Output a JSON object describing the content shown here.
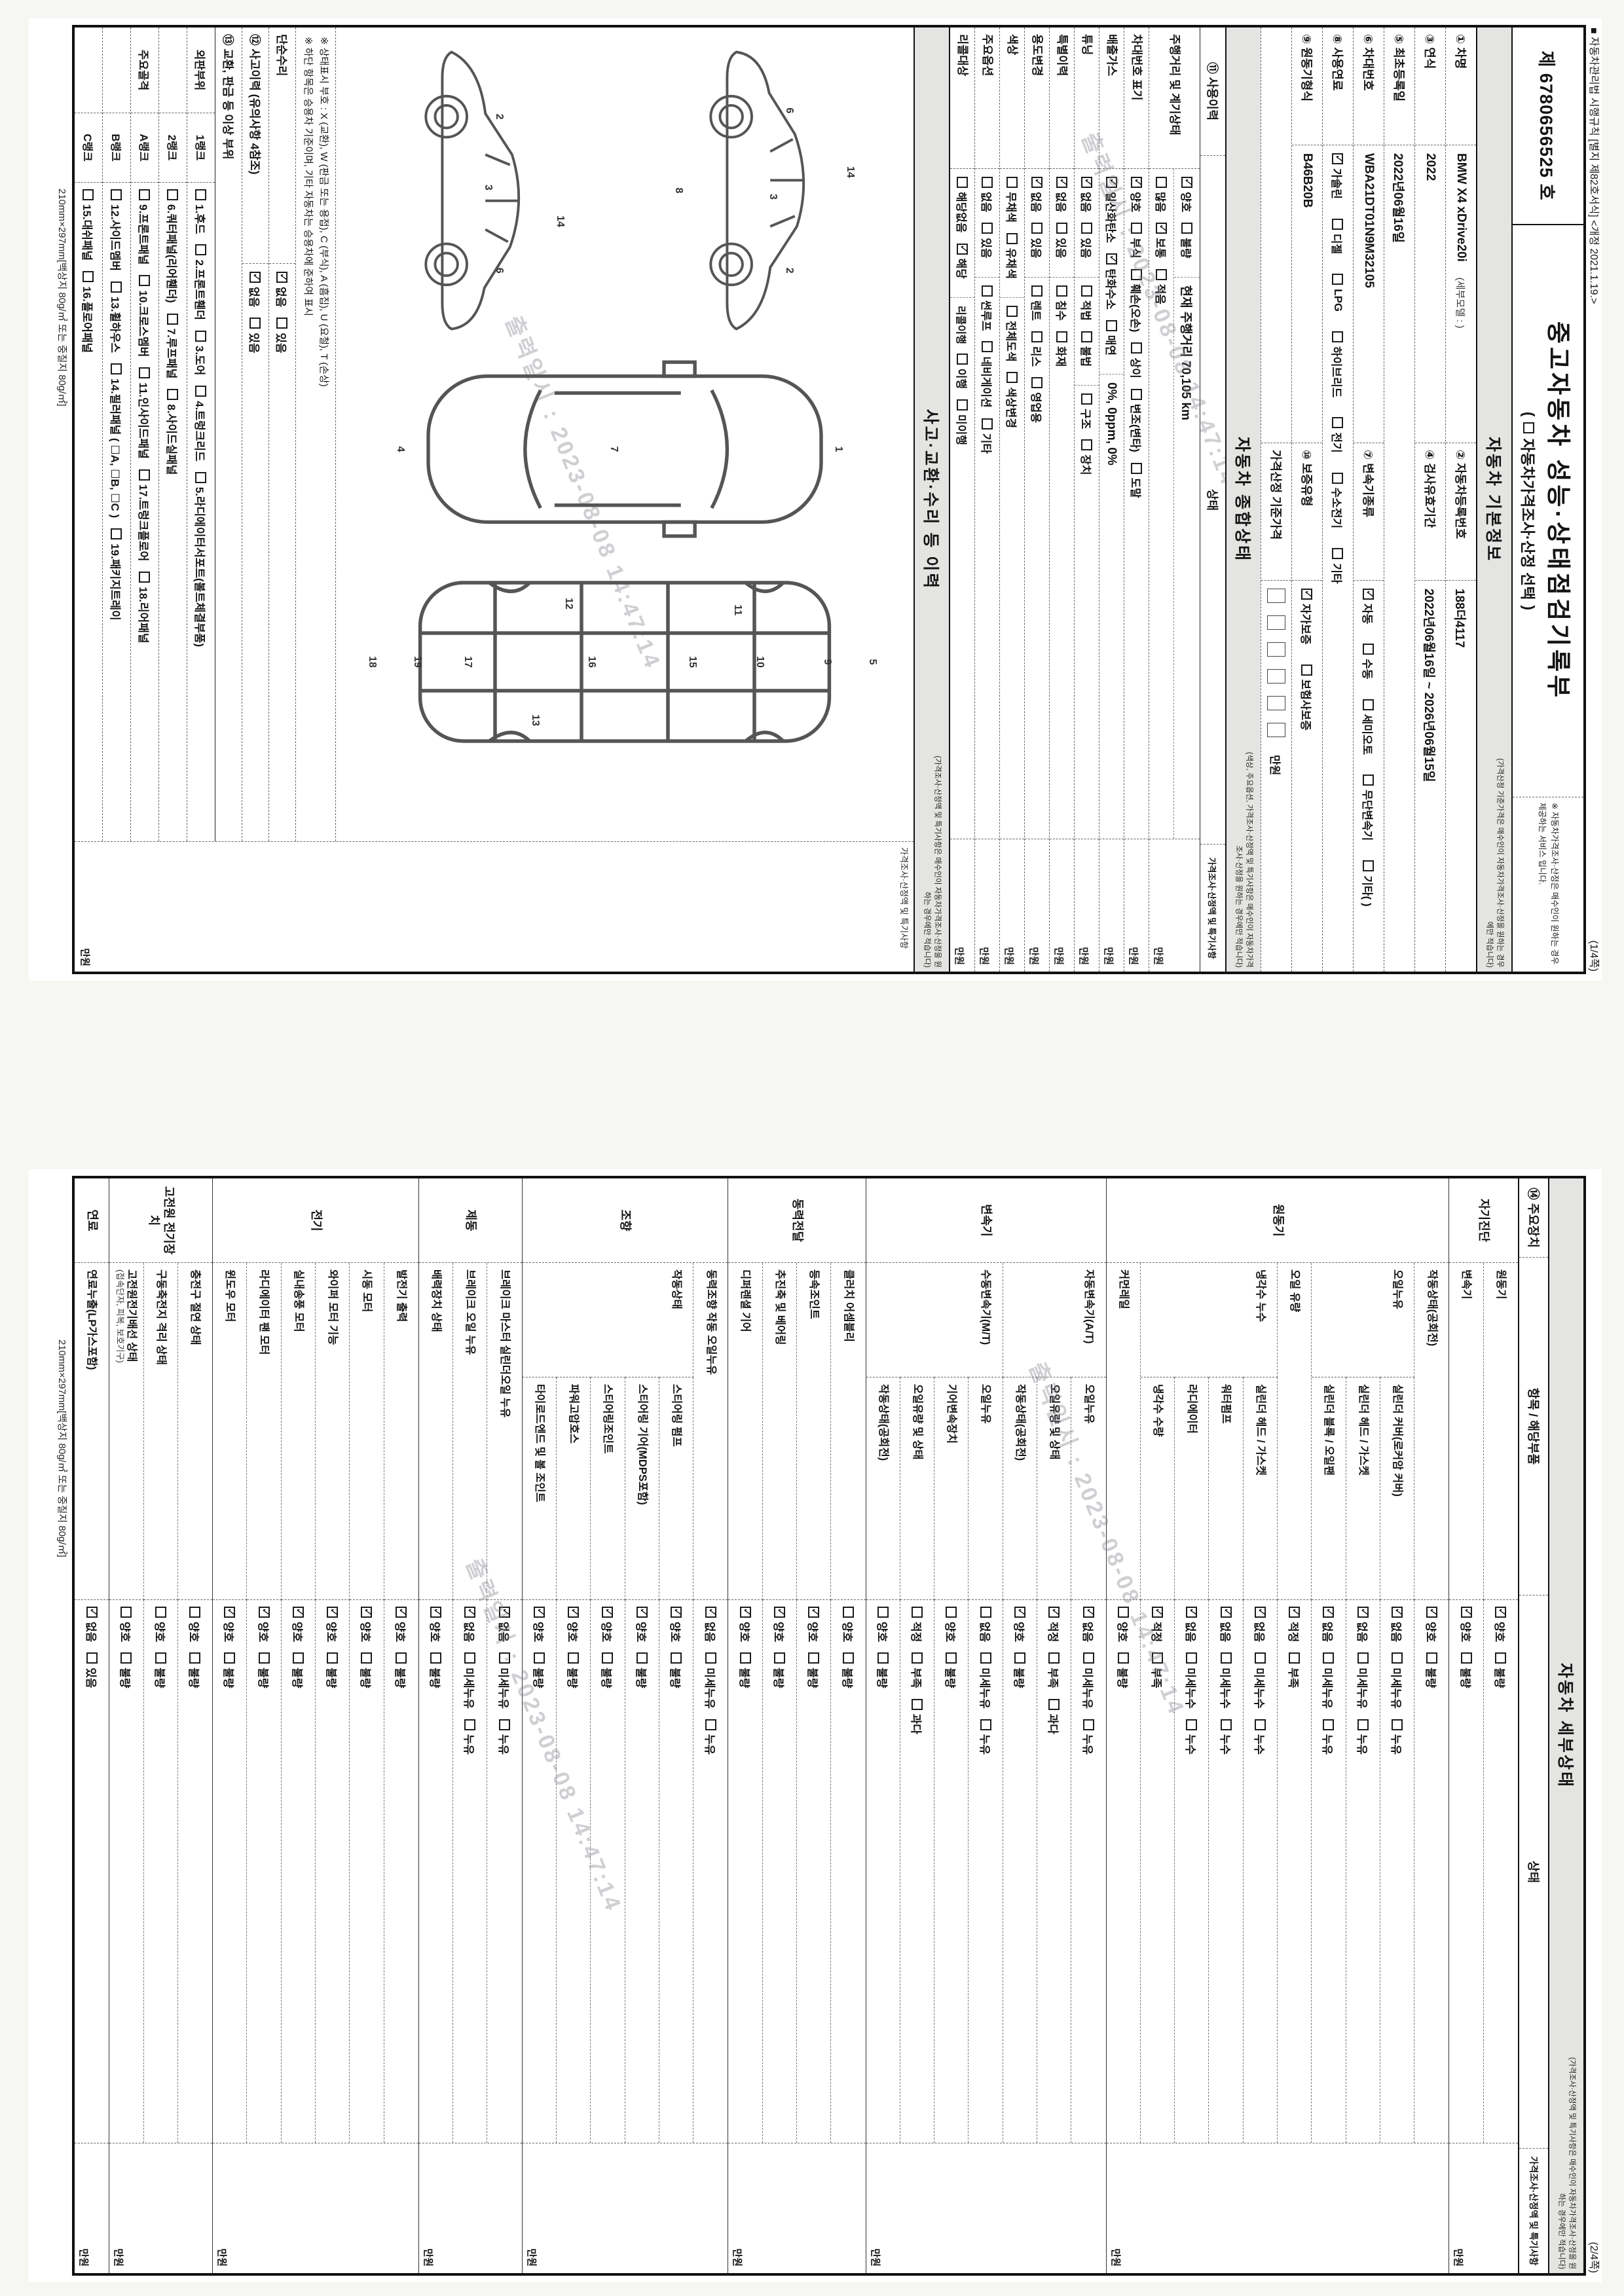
{
  "doc": {
    "regulation_note": "■ 자동차관리법 시행규칙 [별지 제82호서식] <개정 2021.1.19.>",
    "doc_number": "제 6780656525 호",
    "title": "중고자동차 성능·상태점검기록부",
    "subtitle_open": "(",
    "subtitle_text": "자동차가격조사·산정 선택",
    "subtitle_close": ")",
    "service_note": "※ 자동차가격조사·산정은 매수인이 원하는 경우 제공하는 서비스 입니다.",
    "page1_no": "(1/4쪽)",
    "page2_no": "(2/4쪽)",
    "paper_spec": "210mm×297mm[백상지 80g/㎡ 또는 중질지 80g/㎡]",
    "watermark": "출력일시 : 2023-08-08 14:47:14"
  },
  "basic": {
    "section_title": "자동차 기본정보",
    "section_note": "(가격산정 기준가격은 매수인이 자동차가격조사·산정을 원하는 경우에만 적습니다)",
    "car_name_label": "① 차명",
    "car_name": "BMW X4 xDrive20i",
    "car_name_sub": "(세부모델 : )",
    "reg_no_label": "② 자동차등록번호",
    "reg_no": "188더4117",
    "year_label": "③ 연식",
    "year": "2022",
    "inspection_label": "④ 검사유효기간",
    "inspection": "2022년06월16일 ~ 2026년06월15일",
    "first_reg_label": "⑤ 최초등록일",
    "first_reg": "2022년06월16일",
    "vin_label": "⑥ 차대번호",
    "vin": "WBA21DT01N9M32105",
    "trans_label": "⑦ 변속기종류",
    "trans_opts": [
      "✔자동",
      "수동",
      "세미오토",
      "무단변속기",
      "기타(    )"
    ],
    "fuel_label": "⑧ 사용연료",
    "fuel_opts": [
      "✔가솔린",
      "디젤",
      "LPG",
      "하이브리드",
      "전기",
      "수소전기",
      "기타"
    ],
    "engine_label": "⑨ 원동기형식",
    "engine": "B46B20B",
    "warranty_label": "⑩ 보증유형",
    "warranty_opts": [
      "✔자가보증",
      "보험사보증"
    ],
    "base_price_label": "가격산정 기준가격",
    "price_unit": "만원"
  },
  "overall": {
    "section_title": "자동차 종합상태",
    "section_note": "(색상, 주요옵션, 가격조사·산정액 및 특기사항은 매수인이 자동차가격조사·산정을 원하는 경우에만 적습니다)",
    "col_use": "⑪ 사용이력",
    "col_state": "상태",
    "col_price": "가격조사·산정액 및 특기사항",
    "price_unit": "만원",
    "rows": [
      {
        "label": "주행거리 및 계기상태",
        "lines": [
          [
            {
              "opts": [
                "✔양호",
                "불량"
              ]
            },
            {
              "text": "현재 주행거리  70,105 km"
            }
          ],
          [
            {
              "opts": [
                "많음",
                "✔보통",
                "적음"
              ]
            }
          ]
        ]
      },
      {
        "label": "차대번호 표기",
        "lines": [
          [
            {
              "opts": [
                "✔양호",
                "부식",
                "훼손(오손)",
                "상이",
                "변조(변타)",
                "도말"
              ]
            }
          ]
        ]
      },
      {
        "label": "배출가스",
        "lines": [
          [
            {
              "opts": [
                "✔일산화탄소",
                "✔탄화수소",
                "매연"
              ]
            },
            {
              "text": "0%,   0ppm,   0%"
            }
          ]
        ]
      },
      {
        "label": "튜닝",
        "lines": [
          [
            {
              "opts": [
                "✔없음",
                "있음"
              ]
            },
            {
              "opts": [
                "적법",
                "불법"
              ]
            },
            {
              "opts": [
                "구조",
                "장치"
              ]
            }
          ]
        ]
      },
      {
        "label": "특별이력",
        "lines": [
          [
            {
              "opts": [
                "✔없음",
                "있음"
              ]
            },
            {
              "opts": [
                "침수",
                "화재"
              ]
            }
          ]
        ]
      },
      {
        "label": "용도변경",
        "lines": [
          [
            {
              "opts": [
                "✔없음",
                "있음"
              ]
            },
            {
              "opts": [
                "렌트",
                "리스",
                "영업용"
              ]
            }
          ]
        ]
      },
      {
        "label": "색상",
        "lines": [
          [
            {
              "opts": [
                "무채색",
                "유채색"
              ]
            },
            {
              "opts": [
                "전체도색",
                "색상변경"
              ]
            }
          ]
        ]
      },
      {
        "label": "주요옵션",
        "lines": [
          [
            {
              "opts": [
                "없음",
                "있음"
              ]
            },
            {
              "opts": [
                "썬루프",
                "네비게이션",
                "기타"
              ]
            }
          ]
        ]
      },
      {
        "label": "리콜대상",
        "lines": [
          [
            {
              "opts": [
                "해당없음",
                "✔해당"
              ]
            },
            {
              "label2": "리콜이행",
              "opts": [
                "이행",
                "미이행"
              ]
            }
          ]
        ]
      }
    ]
  },
  "history": {
    "section_title": "사고·교환·수리 등 이력",
    "section_note": "(가격조사·산정액 및 특기사항은 매수인이 자동차가격조사·산정을 원하는 경우에만 적습니다)",
    "col_price": "가격조사·산정액 및 특기사항",
    "price_unit": "만원",
    "legend1": "※ 상태표시 부호 : X (교환), W (판금 또는 용접), C (부식), A (흠집), U (요철), T (손상)",
    "legend2": "※ 하단 항목은 승용차 기준이며, 기타 자동차는 승용차에 준하여 표시",
    "simple_repair_label": "단순수리",
    "simple_repair_opts": [
      "✔없음",
      "있음"
    ],
    "accident_label": "⑫ 사고이력 (유의사항 4참조)",
    "accident_opts": [
      "✔없음",
      "있음"
    ],
    "exchange_label": "⑬ 교환, 판금 등 이상 부위",
    "rank_rows": [
      {
        "group": "외판부위",
        "rank": "1랭크",
        "items": [
          "1.후드",
          "2.프론트휀더",
          "3.도어",
          "4.트렁크리드",
          "5.라디에이터서포트(볼트체결부품)"
        ]
      },
      {
        "group": "",
        "rank": "2랭크",
        "items": [
          "6.쿼터패널(리어휀더)",
          "7.루프패널",
          "8.사이드실패널"
        ]
      },
      {
        "group": "주요골격",
        "rank": "A랭크",
        "items": [
          "9.프론트패널",
          "10.크로스멤버",
          "11.인사이드패널",
          "17.트렁크플로어",
          "18.리어패널"
        ]
      },
      {
        "group": "",
        "rank": "B랭크",
        "items": [
          "12.사이드멤버",
          "13.휠하우스",
          "14.필러패널 ( ☐A, ☐B, ☐C )",
          "19.패키지트레이"
        ]
      },
      {
        "group": "",
        "rank": "C랭크",
        "items": [
          "15.대쉬패널",
          "16.플로어패널"
        ]
      }
    ],
    "diagrams": {
      "side_a": [
        {
          "n": "6",
          "x": 24,
          "y": 42
        },
        {
          "n": "14",
          "x": 44,
          "y": 20
        },
        {
          "n": "3",
          "x": 52,
          "y": 48
        },
        {
          "n": "2",
          "x": 76,
          "y": 42
        },
        {
          "n": "8",
          "x": 50,
          "y": 82
        }
      ],
      "top": [
        {
          "n": "1",
          "x": 50,
          "y": 12
        },
        {
          "n": "7",
          "x": 50,
          "y": 52
        },
        {
          "n": "4",
          "x": 50,
          "y": 90
        }
      ],
      "floor": [
        {
          "n": "5",
          "x": 50,
          "y": 6
        },
        {
          "n": "9",
          "x": 50,
          "y": 14
        },
        {
          "n": "10",
          "x": 50,
          "y": 26
        },
        {
          "n": "11",
          "x": 26,
          "y": 30
        },
        {
          "n": "15",
          "x": 50,
          "y": 38
        },
        {
          "n": "16",
          "x": 50,
          "y": 56
        },
        {
          "n": "12",
          "x": 23,
          "y": 60
        },
        {
          "n": "13",
          "x": 77,
          "y": 66
        },
        {
          "n": "17",
          "x": 50,
          "y": 78
        },
        {
          "n": "19",
          "x": 50,
          "y": 87
        },
        {
          "n": "18",
          "x": 50,
          "y": 95
        }
      ],
      "side_b": [
        {
          "n": "2",
          "x": 26,
          "y": 44
        },
        {
          "n": "3",
          "x": 49,
          "y": 48
        },
        {
          "n": "14",
          "x": 60,
          "y": 22
        },
        {
          "n": "6",
          "x": 76,
          "y": 44
        }
      ]
    }
  },
  "detail": {
    "section_title": "자동차 세부상태",
    "section_note": "(가격조사·산정액 및 특기사항은 매수인이 자동차가격조사·산정을 원하는 경우에만 적습니다)",
    "col_device": "⑭ 주요장치",
    "col_item": "항목 / 해당부품",
    "col_state": "상태",
    "col_price": "가격조사·산정액 및 특기사항",
    "price_unit": "만원",
    "groups": [
      {
        "name": "자기진단",
        "rows": [
          {
            "part": "원동기",
            "opts": [
              "✔양호",
              "불량"
            ]
          },
          {
            "part": "변속기",
            "opts": [
              "✔양호",
              "불량"
            ]
          }
        ]
      },
      {
        "name": "원동기",
        "rows": [
          {
            "part": "작동상태(공회전)",
            "opts": [
              "✔양호",
              "불량"
            ]
          },
          {
            "cat": "오일누유",
            "part": "실린더 커버(로커암 커버)",
            "opts": [
              "✔없음",
              "미세누유",
              "누유"
            ]
          },
          {
            "cat": "",
            "part": "실린더 헤드 / 가스켓",
            "opts": [
              "✔없음",
              "미세누유",
              "누유"
            ]
          },
          {
            "cat": "",
            "part": "실린더 블록 / 오일팬",
            "opts": [
              "✔없음",
              "미세누유",
              "누유"
            ]
          },
          {
            "part": "오일 유량",
            "opts": [
              "✔적정",
              "부족"
            ]
          },
          {
            "cat": "냉각수 누수",
            "part": "실린더 헤드 / 가스켓",
            "opts": [
              "✔없음",
              "미세누수",
              "누수"
            ]
          },
          {
            "cat": "",
            "part": "워터펌프",
            "opts": [
              "✔없음",
              "미세누수",
              "누수"
            ]
          },
          {
            "cat": "",
            "part": "라디에이터",
            "opts": [
              "✔없음",
              "미세누수",
              "누수"
            ]
          },
          {
            "cat": "",
            "part": "냉각수 수량",
            "opts": [
              "✔적정",
              "부족"
            ]
          },
          {
            "part": "커먼레일",
            "opts": [
              "양호",
              "불량"
            ]
          }
        ]
      },
      {
        "name": "변속기",
        "rows": [
          {
            "cat": "자동변속기(A/T)",
            "part": "오일누유",
            "opts": [
              "✔없음",
              "미세누유",
              "누유"
            ]
          },
          {
            "cat": "",
            "part": "오일유량 및 상태",
            "opts": [
              "✔적정",
              "부족",
              "과다"
            ]
          },
          {
            "cat": "",
            "part": "작동상태(공회전)",
            "opts": [
              "✔양호",
              "불량"
            ]
          },
          {
            "cat": "수동변속기(M/T)",
            "part": "오일누유",
            "opts": [
              "없음",
              "미세누유",
              "누유"
            ]
          },
          {
            "cat": "",
            "part": "기어변속장치",
            "opts": [
              "양호",
              "불량"
            ]
          },
          {
            "cat": "",
            "part": "오일유량 및 상태",
            "opts": [
              "적정",
              "부족",
              "과다"
            ]
          },
          {
            "cat": "",
            "part": "작동상태(공회전)",
            "opts": [
              "양호",
              "불량"
            ]
          }
        ]
      },
      {
        "name": "동력전달",
        "rows": [
          {
            "part": "클러치 어셈블리",
            "opts": [
              "양호",
              "불량"
            ]
          },
          {
            "part": "등속조인트",
            "opts": [
              "✔양호",
              "불량"
            ]
          },
          {
            "part": "추진축 및 베어링",
            "opts": [
              "✔양호",
              "불량"
            ]
          },
          {
            "part": "디퍼렌셜 기어",
            "opts": [
              "✔양호",
              "불량"
            ]
          }
        ]
      },
      {
        "name": "조향",
        "rows": [
          {
            "part": "동력조향 작동 오일누유",
            "opts": [
              "✔없음",
              "미세누유",
              "누유"
            ]
          },
          {
            "cat": "작동상태",
            "part": "스티어링 펌프",
            "opts": [
              "✔양호",
              "불량"
            ]
          },
          {
            "cat": "",
            "part": "스티어링 기어(MDPS포함)",
            "opts": [
              "✔양호",
              "불량"
            ]
          },
          {
            "cat": "",
            "part": "스티어링조인트",
            "opts": [
              "✔양호",
              "불량"
            ]
          },
          {
            "cat": "",
            "part": "파워고압호스",
            "opts": [
              "✔양호",
              "불량"
            ]
          },
          {
            "cat": "",
            "part": "타이로드엔드 및 볼 조인트",
            "opts": [
              "✔양호",
              "불량"
            ]
          }
        ]
      },
      {
        "name": "제동",
        "rows": [
          {
            "part": "브레이크 마스터 실린더오일 누유",
            "opts": [
              "✔없음",
              "미세누유",
              "누유"
            ]
          },
          {
            "part": "브레이크 오일 누유",
            "opts": [
              "✔없음",
              "미세누유",
              "누유"
            ]
          },
          {
            "part": "배력장치 상태",
            "opts": [
              "✔양호",
              "불량"
            ]
          }
        ]
      },
      {
        "name": "전기",
        "rows": [
          {
            "part": "발전기 출력",
            "opts": [
              "✔양호",
              "불량"
            ]
          },
          {
            "part": "시동 모터",
            "opts": [
              "✔양호",
              "불량"
            ]
          },
          {
            "part": "와이퍼 모터 기능",
            "opts": [
              "✔양호",
              "불량"
            ]
          },
          {
            "part": "실내송풍 모터",
            "opts": [
              "✔양호",
              "불량"
            ]
          },
          {
            "part": "라디에이터 팬 모터",
            "opts": [
              "✔양호",
              "불량"
            ]
          },
          {
            "part": "윈도우 모터",
            "opts": [
              "✔양호",
              "불량"
            ]
          }
        ]
      },
      {
        "name": "고전원 전기장치",
        "rows": [
          {
            "part": "충전구 절연 상태",
            "opts": [
              "양호",
              "불량"
            ]
          },
          {
            "part": "구동축전지 격리 상태",
            "opts": [
              "양호",
              "불량"
            ]
          },
          {
            "part": "고전원전기배선 상태",
            "sub": "(접속단자, 피복, 보호기구)",
            "opts": [
              "양호",
              "불량"
            ]
          }
        ]
      },
      {
        "name": "연료",
        "rows": [
          {
            "part": "연료누출(LP가스포함)",
            "opts": [
              "✔없음",
              "있음"
            ]
          }
        ]
      }
    ]
  }
}
